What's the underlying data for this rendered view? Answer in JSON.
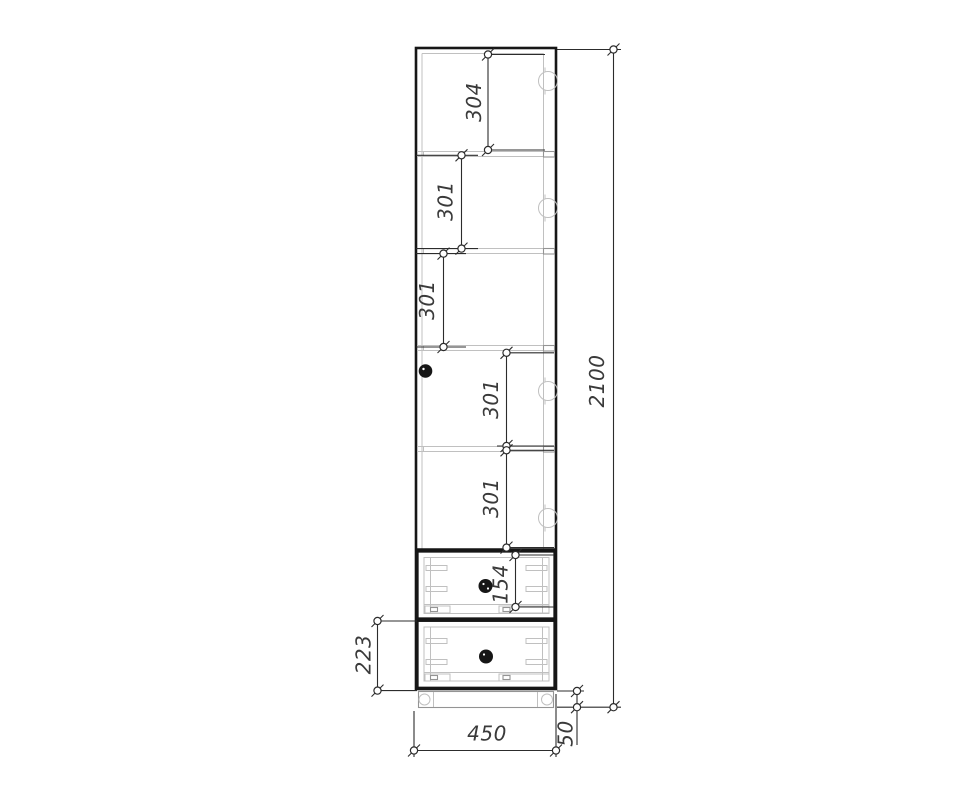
{
  "dimensions": {
    "shelf_spacings": [
      "304",
      "301",
      "301",
      "301",
      "301"
    ],
    "drawer_inner_height": "154",
    "bottom_drawer_height": "223",
    "overall_height": "2100",
    "overall_width": "450",
    "plinth_height": "50"
  },
  "colors": {
    "background": "#ffffff",
    "outline": "#161616",
    "dimension_line": "#2c2c2c",
    "light_detail": "#c0c0c0",
    "label_text": "#3a3a3a"
  }
}
